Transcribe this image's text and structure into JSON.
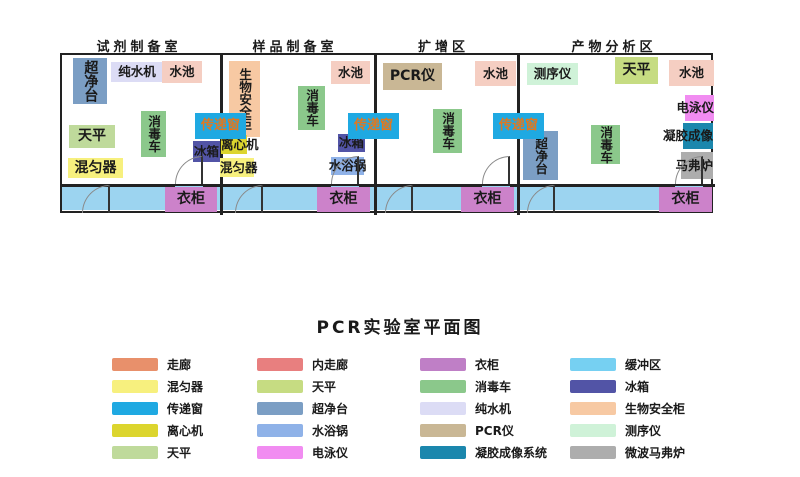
{
  "title": "PCR实验室平面图",
  "floorplan": {
    "room_titles": [
      "试剂制备室",
      "样品制备室",
      "扩增区",
      "产物分析区"
    ],
    "labels": {
      "clean_bench": "超净台",
      "water_purifier": "纯水机",
      "sink": "水池",
      "balance": "天平",
      "disinfection_cart": "消毒车",
      "mixer": "混匀器",
      "transfer_window": "传递窗",
      "fridge": "冰箱",
      "biosafety_cabinet": "生物安全柜",
      "centrifuge": "离心机",
      "water_bath": "水浴锅",
      "pcr": "PCR仪",
      "sequencer": "测序仪",
      "electrophoresis": "电泳仪",
      "gel_imaging": "凝胶成像",
      "muffle_furnace": "马弗炉",
      "wardrobe": "衣柜"
    },
    "colors": {
      "clean_bench": "#7B9EC4",
      "water_purifier": "#DCDCF5",
      "sink": "#F5CEC2",
      "balance": "#BFDA9B",
      "balance2": "#C6DC82",
      "disinfection_cart": "#8BC88B",
      "mixer": "#F7F07E",
      "transfer_window": "#1FA9E2",
      "transfer_window_text": "#E07820",
      "fridge": "#5254A6",
      "biosafety_cabinet": "#F7C9A3",
      "centrifuge": "#DCD52E",
      "water_bath": "#8FB2E8",
      "pcr": "#C9B795",
      "sequencer": "#CFF2D8",
      "electrophoresis": "#F18CF1",
      "gel_imaging": "#1B87AD",
      "muffle_furnace": "#ADADAD",
      "wardrobe": "#CC82CA",
      "buffer_zone": "#9CD4F0"
    }
  },
  "legend": {
    "items": [
      {
        "label": "走廊",
        "color": "#E8906B"
      },
      {
        "label": "混匀器",
        "color": "#F7F07E"
      },
      {
        "label": "传递窗",
        "color": "#1FA9E2"
      },
      {
        "label": "离心机",
        "color": "#DCD52E"
      },
      {
        "label": "天平",
        "color": "#BFDA9B"
      },
      {
        "label": "内走廊",
        "color": "#E87F7F"
      },
      {
        "label": "天平",
        "color": "#C6DC82"
      },
      {
        "label": "超净台",
        "color": "#7B9EC4"
      },
      {
        "label": "水浴锅",
        "color": "#8FB2E8"
      },
      {
        "label": "电泳仪",
        "color": "#F18CF1"
      },
      {
        "label": "衣柜",
        "color": "#BF7FC6"
      },
      {
        "label": "消毒车",
        "color": "#8BC88B"
      },
      {
        "label": "纯水机",
        "color": "#DCDCF5"
      },
      {
        "label": "PCR仪",
        "color": "#C9B795"
      },
      {
        "label": "凝胶成像系统",
        "color": "#1B87AD"
      },
      {
        "label": "缓冲区",
        "color": "#76D0F2"
      },
      {
        "label": "冰箱",
        "color": "#5254A6"
      },
      {
        "label": "生物安全柜",
        "color": "#F7C9A3"
      },
      {
        "label": "测序仪",
        "color": "#CFF2D8"
      },
      {
        "label": "微波马弗炉",
        "color": "#ADADAD"
      }
    ]
  }
}
